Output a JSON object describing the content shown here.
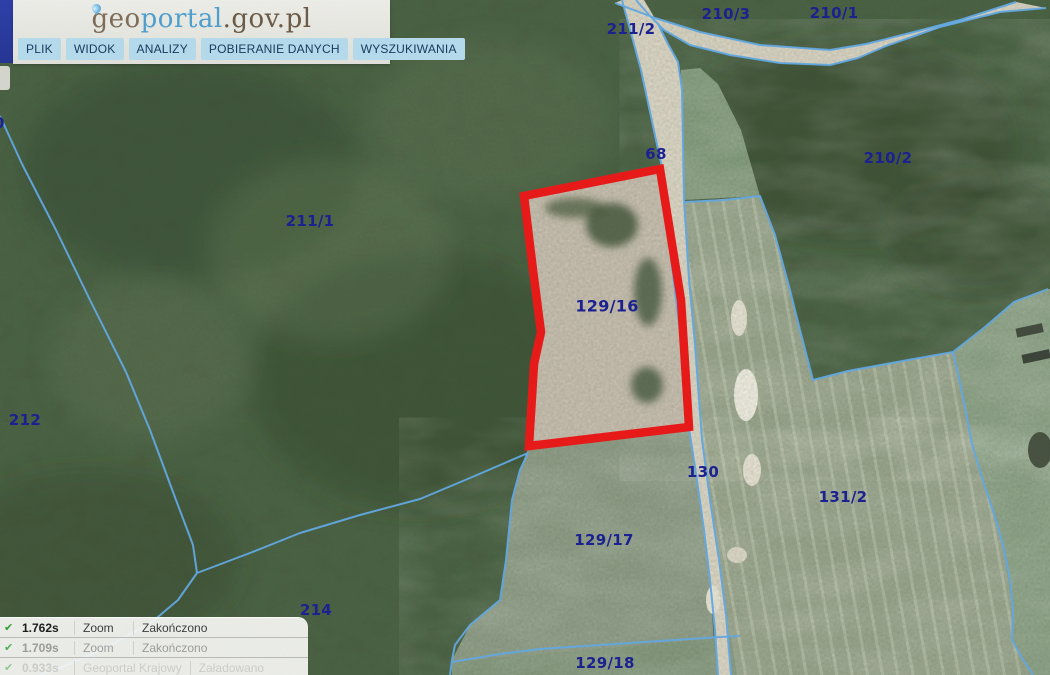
{
  "header": {
    "logo": {
      "geo": "geo",
      "portal": "portal",
      "suffix": ".gov.pl"
    },
    "menu": [
      {
        "label": "PLIK"
      },
      {
        "label": "WIDOK"
      },
      {
        "label": "ANALIZY"
      },
      {
        "label": "POBIERANIE DANYCH"
      },
      {
        "label": "WYSZUKIWANIA"
      }
    ]
  },
  "map": {
    "highlighted_parcel": "129/16",
    "labels": [
      {
        "text": "211/2"
      },
      {
        "text": "210/3"
      },
      {
        "text": "210/1"
      },
      {
        "text": "68"
      },
      {
        "text": "210/2"
      },
      {
        "text": "211/1"
      },
      {
        "text": "212"
      },
      {
        "text": "129/16"
      },
      {
        "text": "130"
      },
      {
        "text": "131/2"
      },
      {
        "text": "129/17"
      },
      {
        "text": "214"
      },
      {
        "text": "129/18"
      },
      {
        "text": "0"
      }
    ]
  },
  "status_log": {
    "entries": [
      {
        "check": "✔",
        "time": "1.762s",
        "action": "Zoom",
        "status": "Zakończono"
      },
      {
        "check": "✔",
        "time": "1.709s",
        "action": "Zoom",
        "status": "Zakończono"
      },
      {
        "check": "✔",
        "time": "0.933s",
        "action": "Geoportal Krajowy",
        "status": "Załadowano"
      }
    ]
  },
  "colors": {
    "highlight_red": "#e71a1a",
    "cadastral_blue": "#62a8e0",
    "label_navy": "#1c2190",
    "menu_button_bg": "#b4d9ea",
    "logo_blue": "#4f9fcc",
    "logo_brown": "#6b5a45",
    "check_green": "#2f9e2f"
  }
}
